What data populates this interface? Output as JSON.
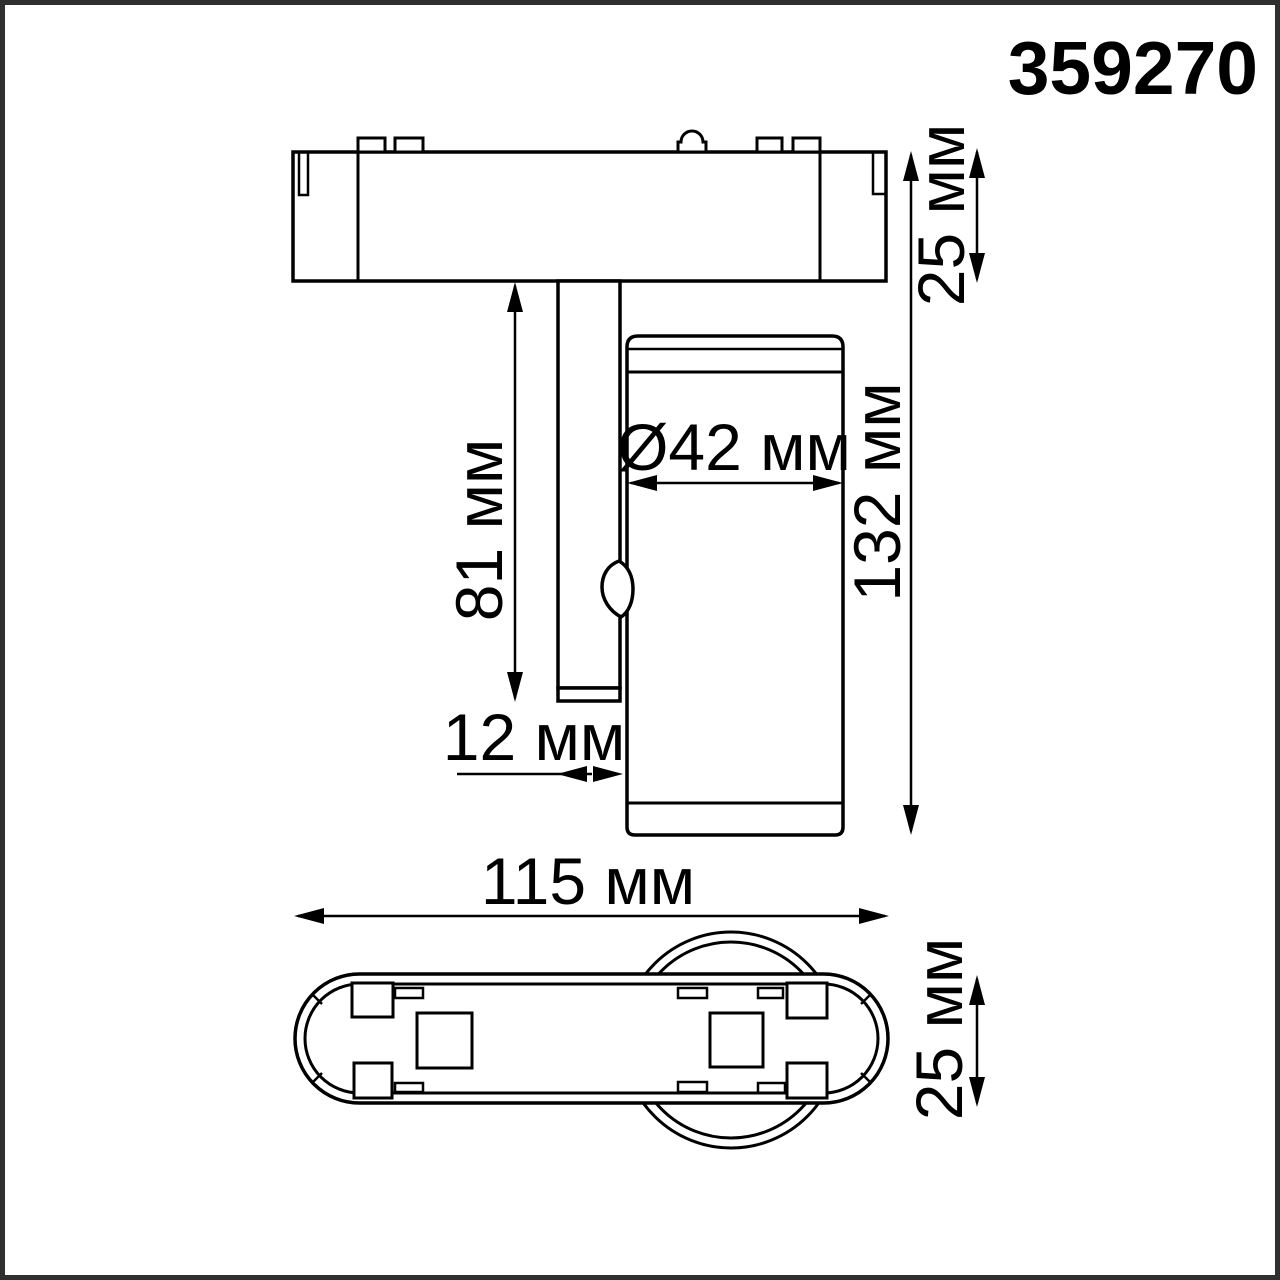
{
  "product_code": "359270",
  "side_view": {
    "base_height_label": "25 мм",
    "stem_length_label": "81 мм",
    "head_diameter_label": "Ø42 мм",
    "total_height_label": "132 мм",
    "stem_width_label": "12 мм"
  },
  "plan_view": {
    "body_length_label": "115 мм",
    "body_width_label": "25 мм"
  },
  "colors": {
    "line": "#000000",
    "background": "#ffffff",
    "frame": "#2f2f2f"
  }
}
